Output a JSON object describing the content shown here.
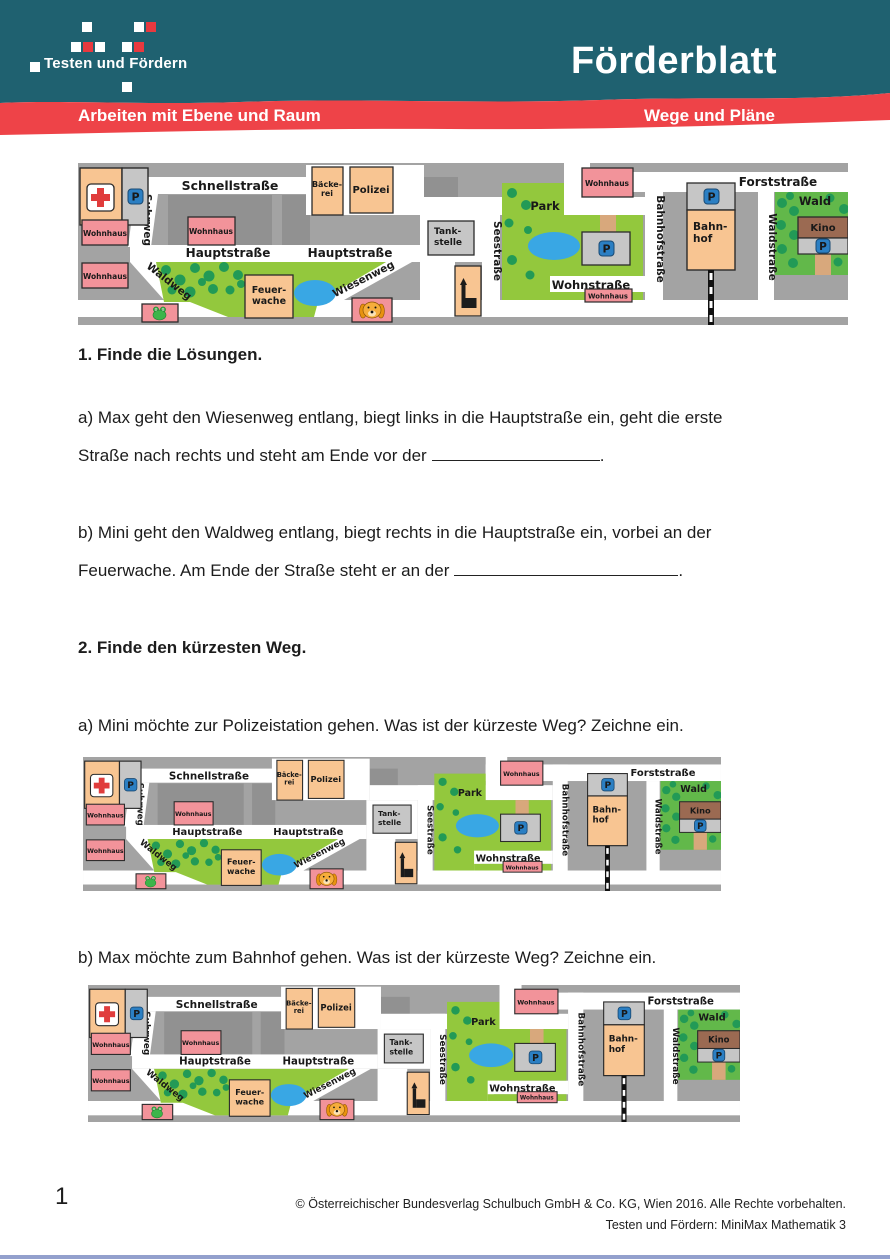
{
  "header": {
    "logo_text": "Testen und Fördern",
    "title": "Förderblatt",
    "banner_left": "Arbeiten mit Ebene und Raum",
    "banner_right": "Wege und Pläne",
    "teal_color": "#1f6170",
    "red_color": "#ee4348"
  },
  "exercises": {
    "ex1_heading": "1. Finde die Lösungen.",
    "ex1_a_line1": "a) Max geht den Wiesenweg entlang, biegt links in die Hauptstraße ein, geht die erste",
    "ex1_a_line2": "Straße nach rechts und steht am Ende vor der",
    "ex1_a_end": ".",
    "ex1_b_line1": "b) Mini geht den Waldweg entlang, biegt rechts in die Hauptstraße ein, vorbei an der",
    "ex1_b_line2": "Feuerwache. Am Ende der Straße steht er an der",
    "ex1_b_end": ".",
    "ex2_heading": "2. Finde den kürzesten Weg.",
    "ex2_a": "a) Mini möchte zur Polizeistation gehen. Was ist der kürzeste Weg? Zeichne ein.",
    "ex2_b": "b) Max möchte zum Bahnhof gehen. Was ist der kürzeste Weg? Zeichne ein."
  },
  "map": {
    "schnellstrasse": "Schnellstraße",
    "suhrweg": "Suhrweg",
    "hauptstrasse": "Hauptstraße",
    "waldweg": "Waldweg",
    "wiesenweg": "Wiesenweg",
    "seestrasse": "Seestraße",
    "wohnstrasse": "Wohnstraße",
    "bahnhofstrasse": "Bahnhofstraße",
    "forststrasse": "Forststraße",
    "waldstrasse": "Waldstraße",
    "wohnhaus": "Wohnhaus",
    "baeckerei_1": "Bäcke-",
    "baeckerei_2": "rei",
    "polizei": "Polizei",
    "feuerwache_1": "Feuer-",
    "feuerwache_2": "wache",
    "tankstelle_1": "Tank-",
    "tankstelle_2": "stelle",
    "bahnhof_1": "Bahn-",
    "bahnhof_2": "hof",
    "park": "Park",
    "wald": "Wald",
    "kino": "Kino",
    "parking": "P",
    "colors": {
      "map_background": "#a3a3a3",
      "street": "#ffffff",
      "building_orange": "#f8c592",
      "building_pink": "#f2939a",
      "building_gray": "#c6c6c6",
      "park_green": "#93c83d",
      "forest_green": "#62b84a",
      "tree_green": "#229a56",
      "pond_blue": "#39a7e4",
      "parking_blue": "#2b7fc3",
      "kino_brown": "#9b6a52",
      "cross_red": "#e03c3c",
      "path_tan": "#d8a87c"
    }
  },
  "footer": {
    "page_number": "1",
    "copyright": "© Österreichischer Bundesverlag Schulbuch GmbH & Co. KG, Wien 2016. Alle Rechte vorbehalten.",
    "series": "Testen und Fördern: MiniMax Mathematik 3"
  }
}
